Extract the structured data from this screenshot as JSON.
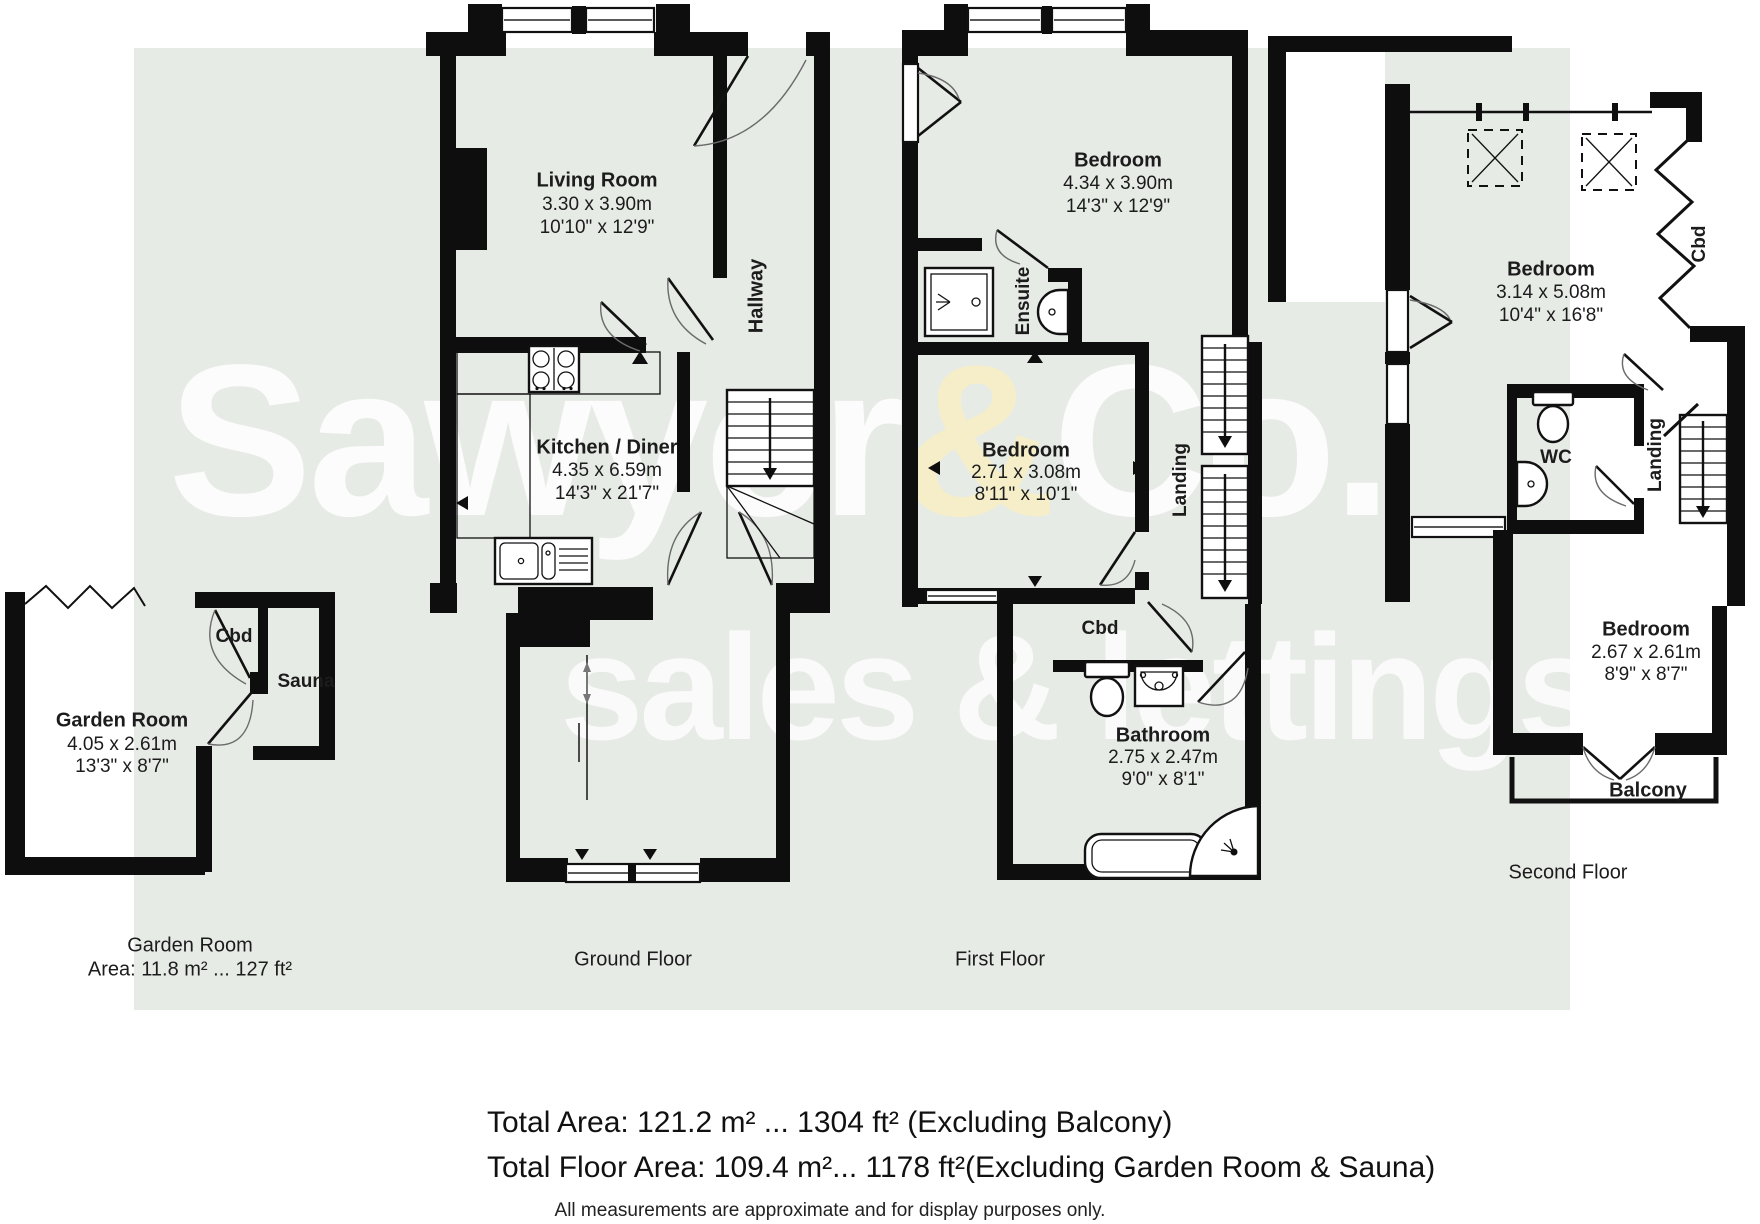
{
  "watermark": {
    "part1": "Sawyer",
    "amp1": "&",
    "part2": "Co.",
    "line2": "sales & lettings",
    "accent_color": "#f5eec6"
  },
  "colors": {
    "background_band": "#e7ebe6",
    "wall": "#0e0e0e",
    "page": "#ffffff"
  },
  "floors": {
    "garden": {
      "caption_line1": "Garden Room",
      "caption_line2": "Area: 11.8 m² ... 127 ft²",
      "rooms": {
        "garden_room": {
          "name": "Garden Room",
          "metric": "4.05 x 2.61m",
          "imperial": "13'3\" x 8'7\""
        },
        "cbd": {
          "name": "Cbd"
        },
        "sauna": {
          "name": "Sauna"
        }
      }
    },
    "ground": {
      "caption": "Ground Floor",
      "rooms": {
        "living": {
          "name": "Living Room",
          "metric": "3.30 x 3.90m",
          "imperial": "10'10\" x 12'9\""
        },
        "hallway": {
          "name": "Hallway"
        },
        "kitchen": {
          "name": "Kitchen / Diner",
          "metric": "4.35 x 6.59m",
          "imperial": "14'3\" x 21'7\""
        }
      }
    },
    "first": {
      "caption": "First Floor",
      "rooms": {
        "bedroom1": {
          "name": "Bedroom",
          "metric": "4.34 x 3.90m",
          "imperial": "14'3\" x 12'9\""
        },
        "ensuite": {
          "name": "Ensuite"
        },
        "bedroom2": {
          "name": "Bedroom",
          "metric": "2.71 x 3.08m",
          "imperial": "8'11\" x 10'1\""
        },
        "landing": {
          "name": "Landing"
        },
        "cbd": {
          "name": "Cbd"
        },
        "bathroom": {
          "name": "Bathroom",
          "metric": "2.75 x 2.47m",
          "imperial": "9'0\" x 8'1\""
        }
      }
    },
    "second": {
      "caption": "Second Floor",
      "rooms": {
        "bedroom3": {
          "name": "Bedroom",
          "metric": "3.14 x 5.08m",
          "imperial": "10'4\" x 16'8\""
        },
        "cbd": {
          "name": "Cbd"
        },
        "wc": {
          "name": "WC"
        },
        "landing": {
          "name": "Landing"
        },
        "bedroom4": {
          "name": "Bedroom",
          "metric": "2.67 x 2.61m",
          "imperial": "8'9\" x 8'7\""
        },
        "balcony": {
          "name": "Balcony"
        }
      }
    }
  },
  "summary": {
    "total_area": "Total Area: 121.2 m² ... 1304 ft² (Excluding Balcony)",
    "total_floor_area": "Total Floor Area: 109.4 m²... 1178 ft²(Excluding Garden Room & Sauna)",
    "disclaimer": "All measurements are approximate and for display purposes only."
  }
}
